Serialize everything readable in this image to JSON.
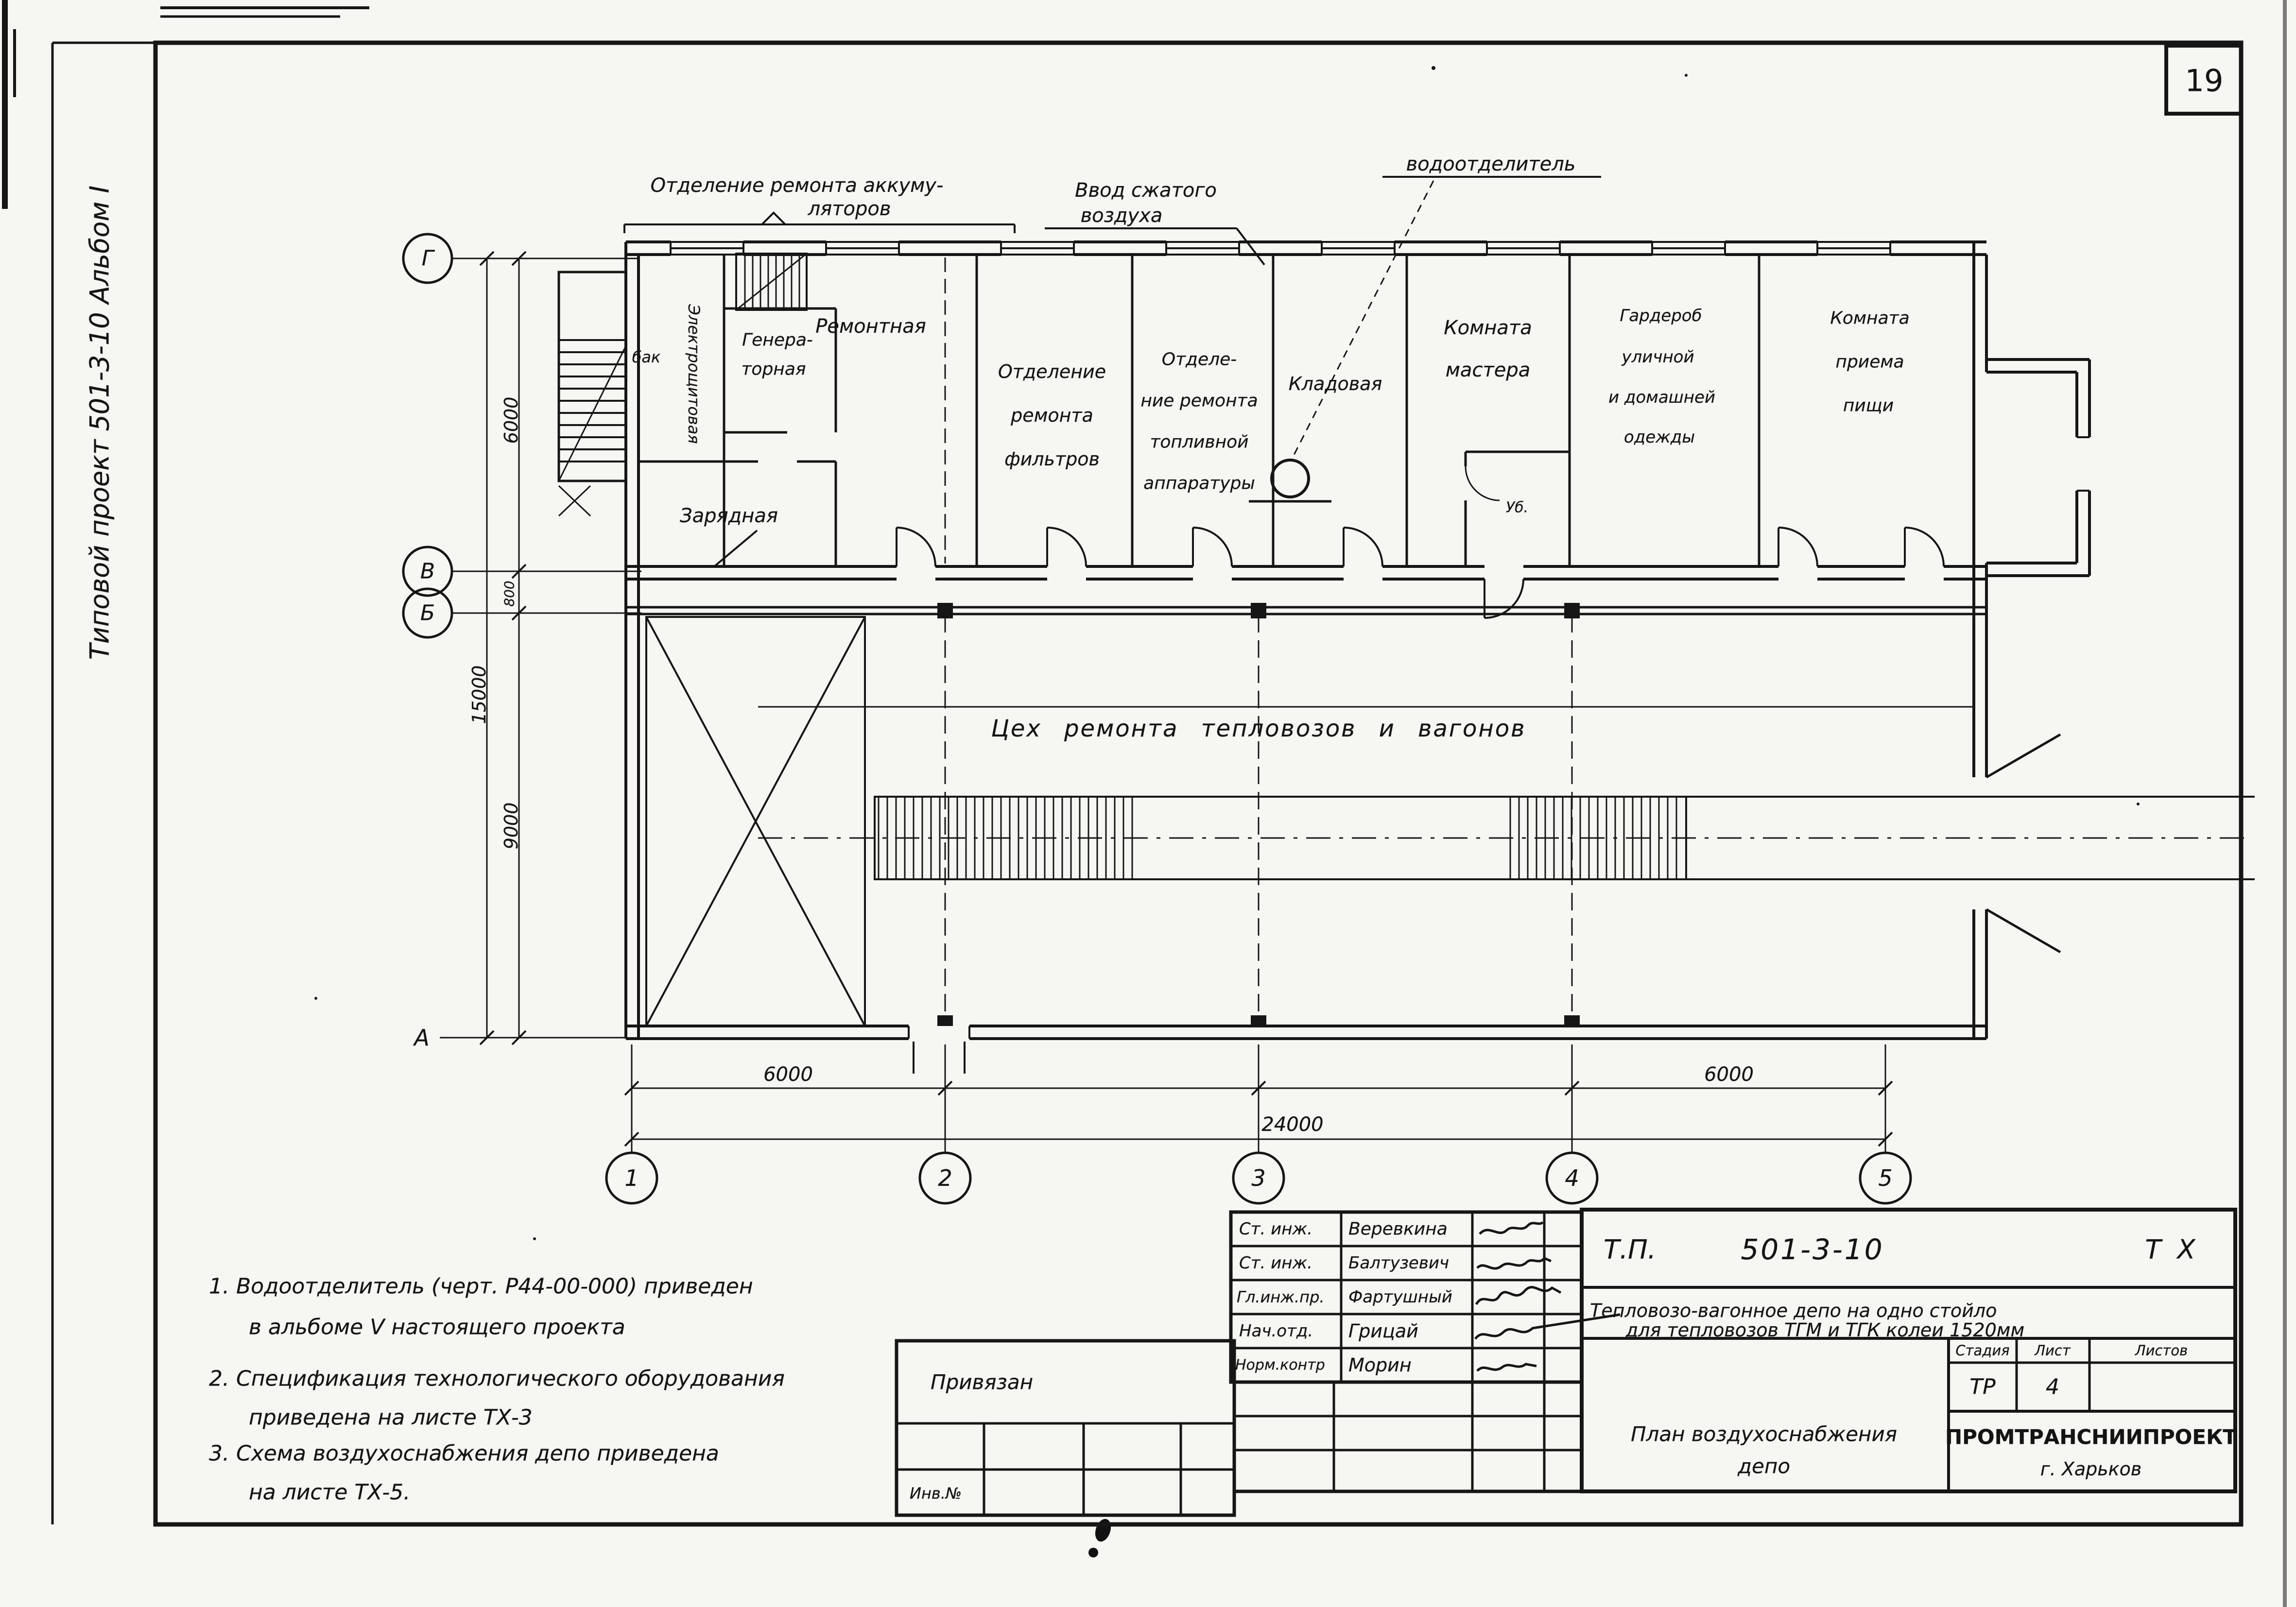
{
  "sheet": {
    "number": "19",
    "margin_note": "Типовой проект 501-3-10 Альбом I"
  },
  "callouts": {
    "accumulator_line1": "Отделение ремонта аккуму-",
    "accumulator_line2": "ляторов",
    "air_line1": "Ввод сжатого",
    "air_line2": "воздуха",
    "water_separator": "водоотделитель"
  },
  "rooms": {
    "tank": "бак",
    "electrical": "Электрощитовая",
    "generator_line1": "Генера-",
    "generator_line2": "торная",
    "charging": "Зарядная",
    "repair": "Ремонтная",
    "filters_line1": "Отделение",
    "filters_line2": "ремонта",
    "filters_line3": "фильтров",
    "fuel_line1": "Отделе-",
    "fuel_line2": "ние ремонта",
    "fuel_line3": "топливной",
    "fuel_line4": "аппаратуры",
    "storeroom": "Кладовая",
    "master_line1": "Комната",
    "master_line2": "мастера",
    "wc": "Уб.",
    "wardrobe_line1": "Гардероб",
    "wardrobe_line2": "уличной",
    "wardrobe_line3": "и домашней",
    "wardrobe_line4": "одежды",
    "dining_line1": "Комната",
    "dining_line2": "приема",
    "dining_line3": "пищи",
    "hall": "Цех ремонта тепловозов и вагонов"
  },
  "axes": {
    "row_g": "Г",
    "row_v": "В",
    "row_b": "Б",
    "row_a": "А",
    "col_1": "1",
    "col_2": "2",
    "col_3": "3",
    "col_4": "4",
    "col_5": "5"
  },
  "dims": {
    "span_12": "6000",
    "span_45": "6000",
    "total_width": "24000",
    "row_gv": "6000",
    "row_vb": "800",
    "row_ba": "9000",
    "total_depth": "15000"
  },
  "notes": {
    "n1l1": "1. Водоотделитель (черт. Р44-00-000) приведен",
    "n1l2": "в альбоме V настоящего проекта",
    "n2l1": "2. Спецификация технологического оборудования",
    "n2l2": "приведена на листе ТХ-3",
    "n3l1": "3. Схема воздухоснабжения депо приведена",
    "n3l2": "на листе ТХ-5."
  },
  "titleblock": {
    "staff": [
      {
        "role": "Ст. инж.",
        "name": "Веревкина"
      },
      {
        "role": "Ст. инж.",
        "name": "Балтузевич"
      },
      {
        "role": "Гл.инж.пр.",
        "name": "Фартушный"
      },
      {
        "role": "Нач.отд.",
        "name": "Грицай"
      },
      {
        "role": "Норм.контр",
        "name": "Морин"
      }
    ],
    "doc_prefix": "Т.П.",
    "doc_number": "501-3-10",
    "doc_mark": "Т Х",
    "project_line1": "Тепловозо-вагонное депо на одно стойло",
    "project_line2": "для тепловозов ТГМ и ТГК колеи 1520мм",
    "sheet_title_line1": "План воздухоснабжения",
    "sheet_title_line2": "депо",
    "stage_label": "Стадия",
    "list_label": "Лист",
    "lists_label": "Листов",
    "stage_value": "ТР",
    "list_value": "4",
    "lists_value": "",
    "org": "ПРОМТРАНСНИИПРОЕКТ",
    "city": "г. Харьков",
    "attached": "Привязан",
    "inventory": "Инв.№"
  }
}
